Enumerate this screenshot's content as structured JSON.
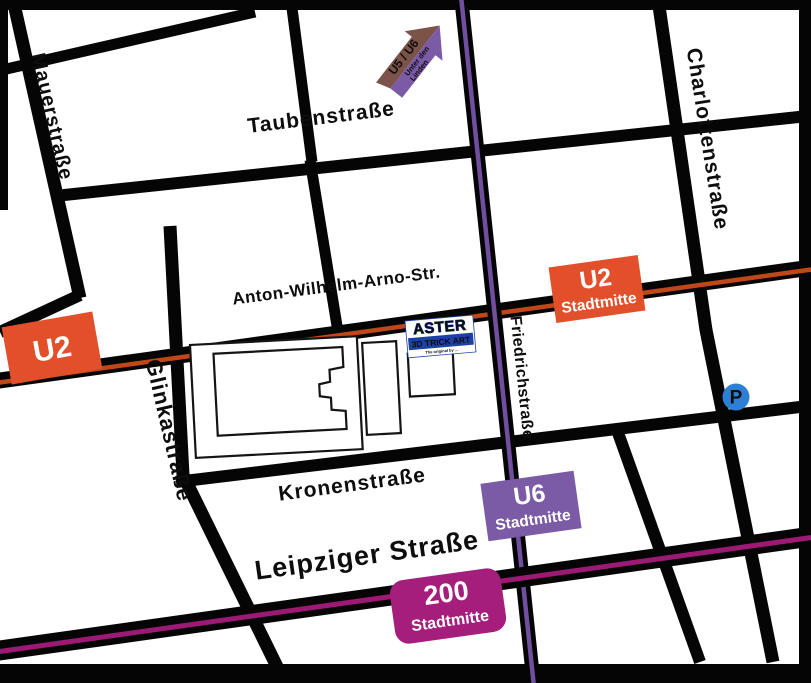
{
  "map": {
    "streets": {
      "mauer": "Mauerstraße",
      "tauben": "Taubenstraße",
      "charlotten": "Charlottenstraße",
      "anton": "Anton-Wilhelm-Arno-Str.",
      "glinka": "Glinkastraße",
      "friedrich": "Friedrichstraße",
      "kronen": "Kronenstraße",
      "leipziger": "Leipziger Straße"
    },
    "badges": {
      "u2_west": {
        "line": "U2"
      },
      "u2_stadtmitte": {
        "line": "U2",
        "station": "Stadtmitte"
      },
      "u6_stadtmitte": {
        "line": "U6",
        "station": "Stadtmitte"
      },
      "bus200": {
        "line": "200",
        "station": "Stadtmitte"
      }
    },
    "arrow": {
      "lines": "U5 / U6",
      "dest1": "Unter den",
      "dest2": "Linden"
    },
    "venue": {
      "name": "ASTER",
      "subtitle": "3D TRICK ART",
      "tagline": "The original by ..."
    },
    "parking": {
      "label": "P"
    },
    "colors": {
      "street": "#050505",
      "u2": "#E2502B",
      "u2_stripe": "#C04818",
      "u6": "#7B5AA6",
      "u6_stripe": "#6F4F9E",
      "bus200": "#A51E7C",
      "bus200_stripe": "#9C1A74",
      "arrow_brown": "#7B5348",
      "arrow_purple": "#7C5BA6",
      "arrow_dest_text": "#2E2440",
      "parking_blue": "#2E80D6",
      "logo_blue": "#1C3FA8",
      "logo_yellow": "#FFD400"
    }
  }
}
